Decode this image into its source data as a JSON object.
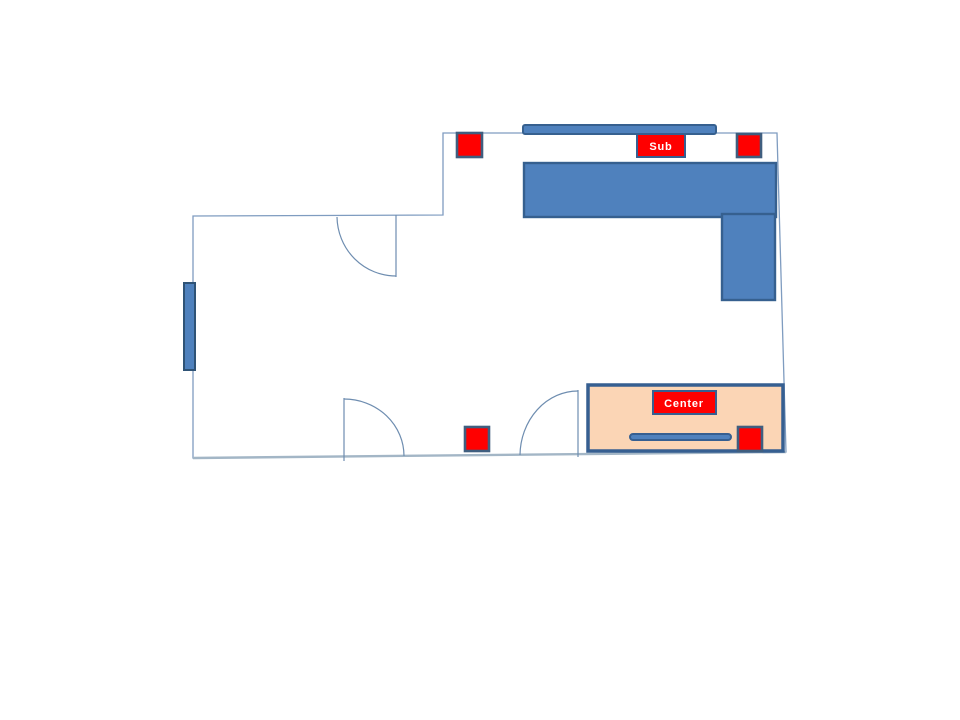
{
  "colors": {
    "furniture_fill": "#4f81bd",
    "furniture_border": "#36608f",
    "speaker_fill": "#ff0000",
    "speaker_border": "#3f5e7f",
    "zone_fill": "#fbd5b5",
    "zone_border": "#365f91",
    "wall_line": "#7f9cc0",
    "floor_line": "#a3b6c6",
    "label_bg": "#ff0000",
    "label_text": "#ffffff"
  },
  "floor_plan": {
    "labels": {
      "sub": "Sub",
      "center": "Center"
    }
  }
}
